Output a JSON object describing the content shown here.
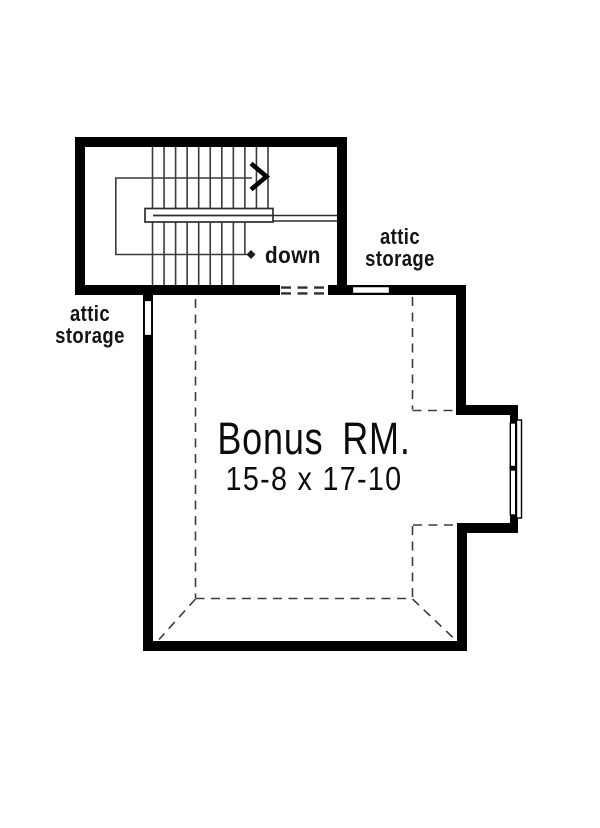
{
  "plan": {
    "room": {
      "name": "Bonus RM.",
      "dimensions": "15-8 x 17-10"
    },
    "attic_storage_left": {
      "line1": "attic",
      "line2": "storage"
    },
    "attic_storage_right": {
      "line1": "attic",
      "line2": "storage"
    },
    "stairs": {
      "direction_label": "down"
    },
    "colors": {
      "wall": "#000000",
      "thin_line": "#3a3a3a",
      "background": "#ffffff"
    }
  }
}
